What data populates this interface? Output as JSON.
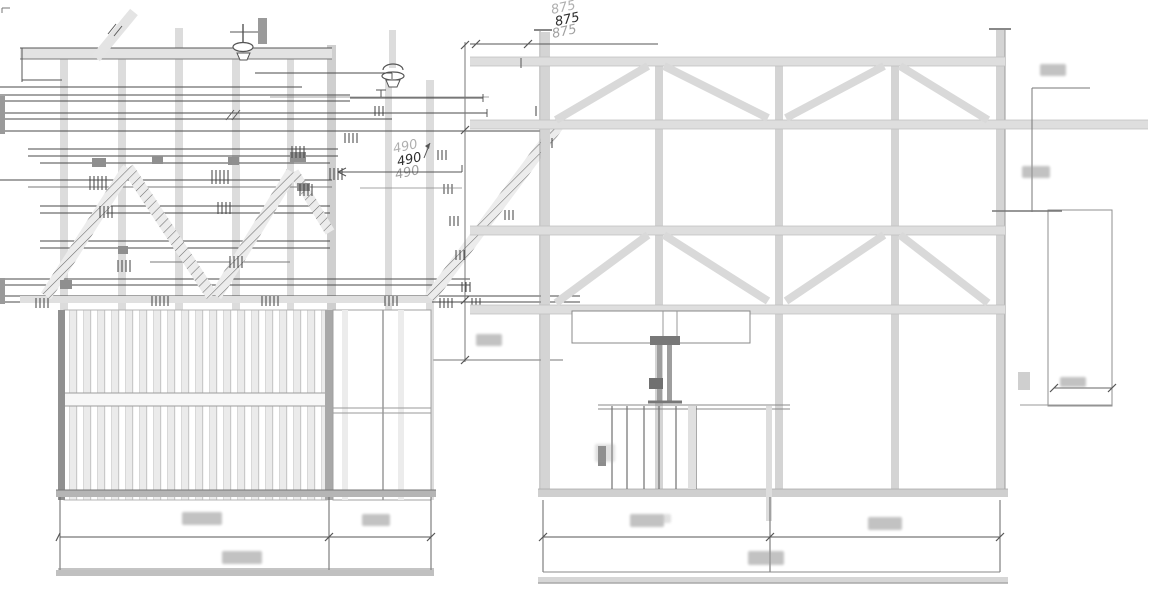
{
  "drawing": {
    "kind": "technical-elevation-blueprint",
    "dimensions": {
      "top_span": "875",
      "mid_span": "490"
    },
    "views": {
      "left": {
        "name": "truss-and-slat-panel-elevation"
      },
      "right": {
        "name": "braced-frame-elevation-with-jack"
      }
    },
    "colors": {
      "ink": "#4a4a4a",
      "member_light": "#d9d9d9",
      "member_dark": "#9a9a9a",
      "background": "#ffffff"
    }
  }
}
